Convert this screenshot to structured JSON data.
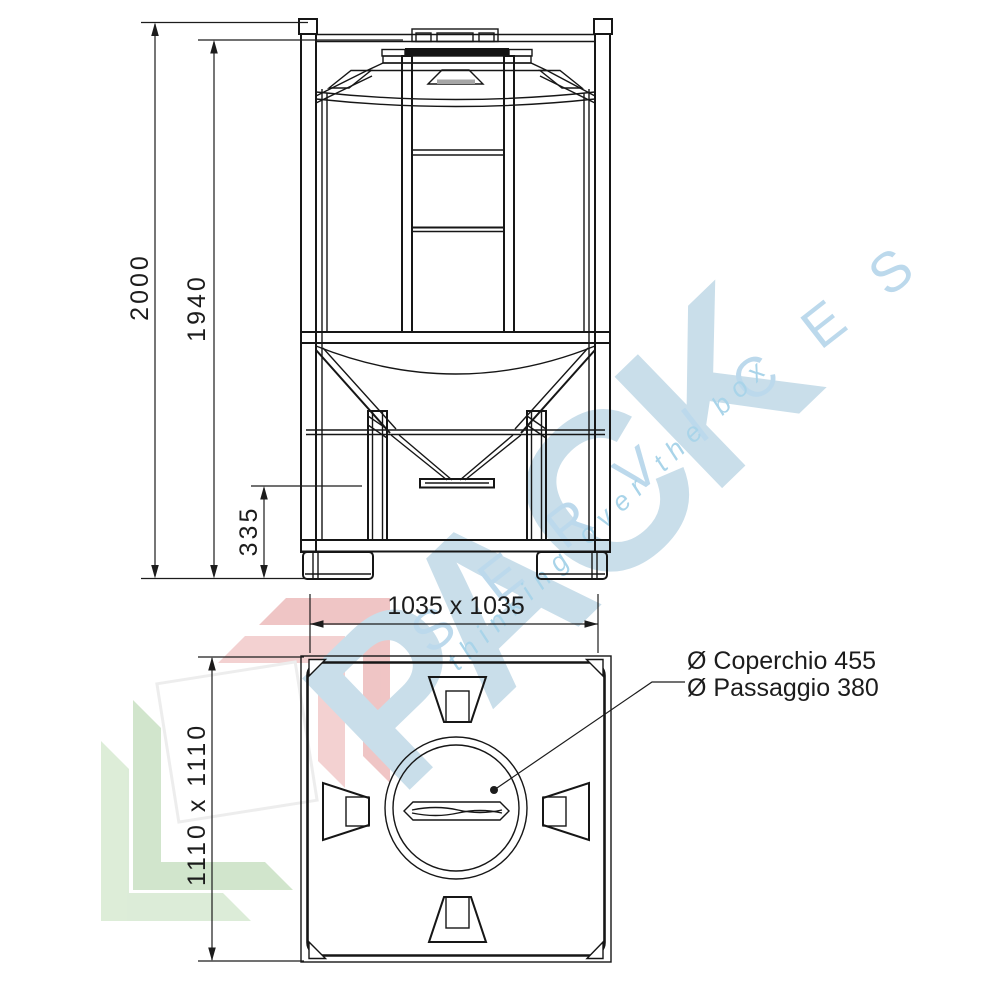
{
  "watermark": {
    "brand": "PACK",
    "brand_sub": "SERVICES",
    "tagline": "thinking over the box"
  },
  "front_view": {
    "overall_height": "2000",
    "frame_height": "1940",
    "outlet_height": "335"
  },
  "plan_view": {
    "internal_size": "1035 x 1035",
    "external_size": "1110 x 1110",
    "lid_label_line1": "Ø Coperchio 455",
    "lid_label_line2": "Ø Passaggio 380"
  },
  "colors": {
    "line": "#161616",
    "watermark_blue": "#c9deea",
    "watermark_mid_blue": "#bcd9ec",
    "watermark_script_blue": "#a9d4e9",
    "logo_pink": "#eebfbf",
    "logo_pink_light": "#f2cdcd",
    "logo_green": "#cde3c7",
    "logo_green_light": "#d9ebd4"
  }
}
